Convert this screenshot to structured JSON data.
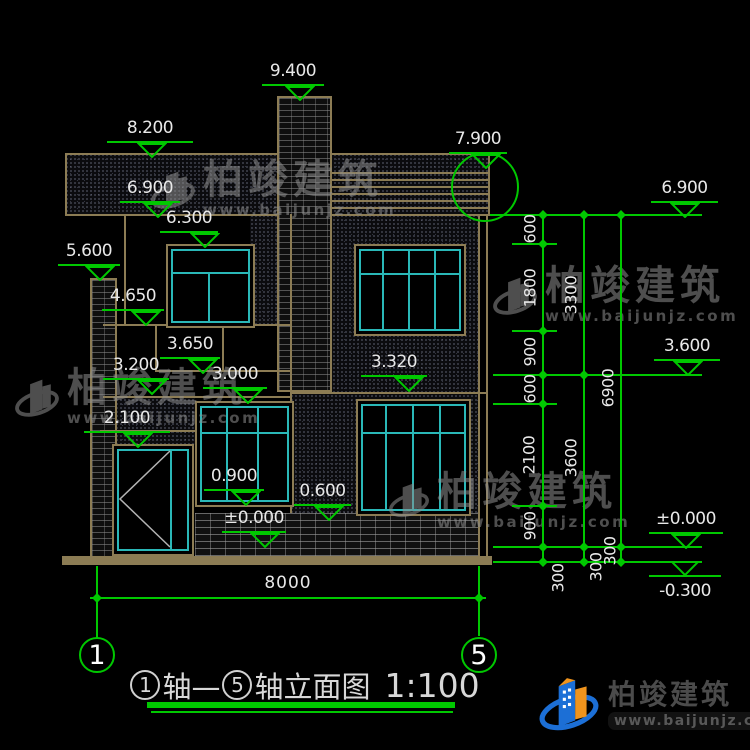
{
  "drawing": {
    "bottom_width_dim": "8000",
    "axis_start": "1",
    "axis_end": "5"
  },
  "title": {
    "a1": "1",
    "seg1": "轴—",
    "a2": "5",
    "seg2": "轴立面图",
    "scale": "1:100"
  },
  "levels": {
    "9400": "9.400",
    "8200": "8.200",
    "7900": "7.900",
    "6900": "6.900",
    "6300": "6.300",
    "5600": "5.600",
    "4650": "4.650",
    "3650": "3.650",
    "3200": "3.200",
    "3000": "3.000",
    "3320": "3.320",
    "2100": "2.100",
    "0900": "0.900",
    "0600": "0.600",
    "pm0": "±0.000",
    "r6900": "6.900",
    "r3600": "3.600",
    "rpm0": "±0.000",
    "rm300": "-0.300"
  },
  "dims": {
    "c1": [
      "600",
      "1800",
      "900",
      "600",
      "2100",
      "900",
      "300"
    ],
    "c2": [
      "3300",
      "3600",
      "300"
    ],
    "c3": [
      "6900",
      "300"
    ]
  },
  "brand": {
    "name": "柏竣建筑",
    "url": "www.baijunjz.com"
  },
  "colors": {
    "line_green": "#00c800",
    "frame_tan": "#8c7c54",
    "window_cyan": "#2ab8b8",
    "logo_blue": "#1c6fd6",
    "logo_orange": "#f0941d"
  }
}
